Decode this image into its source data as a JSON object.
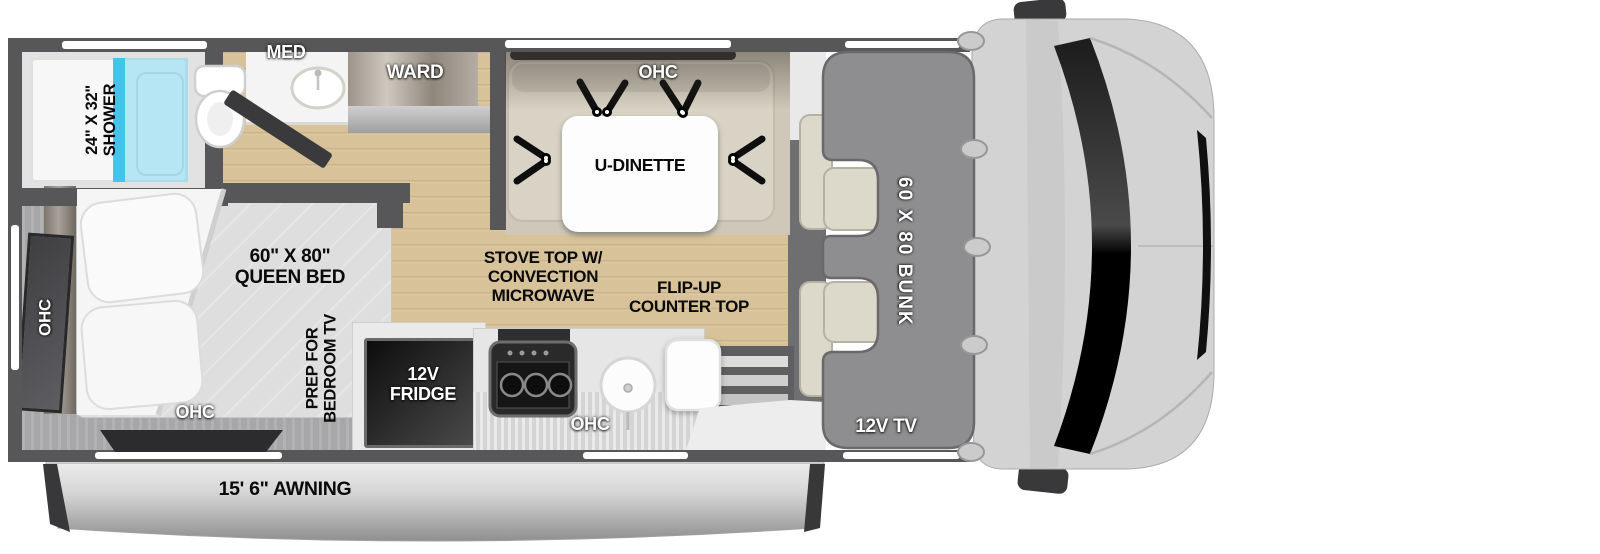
{
  "labels": {
    "shower_size": "24\" X 32\"",
    "shower": "SHOWER",
    "med": "MED",
    "ward": "WARD",
    "dinette_ohc": "OHC",
    "u_dinette": "U-DINETTE",
    "bed_size": "60\" X 80\"",
    "bed": "QUEEN BED",
    "bedroom_ohc_side": "OHC",
    "bedroom_ohc_bottom": "OHC",
    "tv_prep_1": "PREP FOR",
    "tv_prep_2": "BEDROOM TV",
    "fridge_1": "12V",
    "fridge_2": "FRIDGE",
    "stove_1": "STOVE TOP W/",
    "stove_2": "CONVECTION",
    "stove_3": "MICROWAVE",
    "flip_1": "FLIP-UP",
    "flip_2": "COUNTER TOP",
    "kitchen_ohc": "OHC",
    "bunk": "60 X 80 BUNK",
    "cab_tv": "12V TV",
    "awning": "15' 6\" AWNING"
  },
  "colors": {
    "wall": "#57575a",
    "wood_floor": "#d8c299",
    "carpet": "#a7a7a9",
    "shower_glass": "#45c4ea",
    "dinette_bench": "#d9d3c5",
    "bunk_gray": "#8e8e90",
    "cab_gray": "#d3d3d3",
    "awning_silver": "#c9c9c9",
    "fridge_black": "#1c1c1c"
  }
}
